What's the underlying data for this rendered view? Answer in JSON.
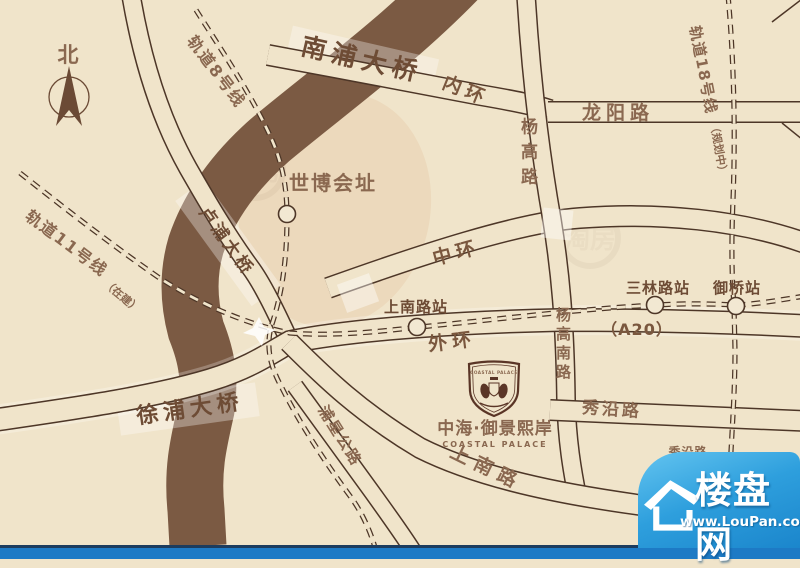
{
  "compass": {
    "north": "北"
  },
  "metro": {
    "line8": "轨道8号线",
    "line11": "轨道11号线",
    "line11_status": "（在建）",
    "line18": "轨道18号线",
    "line18_status": "（规划中）"
  },
  "roads": {
    "nanpu_bridge": "南浦大桥",
    "inner_ring": "内环",
    "yanggao": "杨高路",
    "longyang": "龙阳路",
    "lupu_bridge": "卢浦大桥",
    "middle_ring": "中环",
    "outer_ring": "外环",
    "a20": "（A20）",
    "yanggao_south": "杨高南路",
    "xupu_bridge": "徐浦大桥",
    "puxing_highway": "浦星公路",
    "xiuyan": "秀沿路",
    "xiuyan_small": "秀沿路",
    "shangnan": "上南路"
  },
  "stations": {
    "shangnan": "上南路站",
    "sanlin": "三林路站",
    "yuqiao": "御桥站"
  },
  "places": {
    "expo_site": "世博会址"
  },
  "project": {
    "name_cn": "中海·御景熙岸",
    "name_en": "COASTAL PALACE",
    "crest_text": "COASTAL PALACE"
  },
  "brand": {
    "site_name": "楼盘网",
    "site_url": "www.LouPan.com"
  },
  "watermark": {
    "text": "淘房"
  },
  "colors": {
    "background": "#f0e4ca",
    "river": "#7b5a43",
    "road_line": "#4d3627",
    "label_brown": "#8a6850",
    "badge_blue": "#1d7ac5"
  }
}
